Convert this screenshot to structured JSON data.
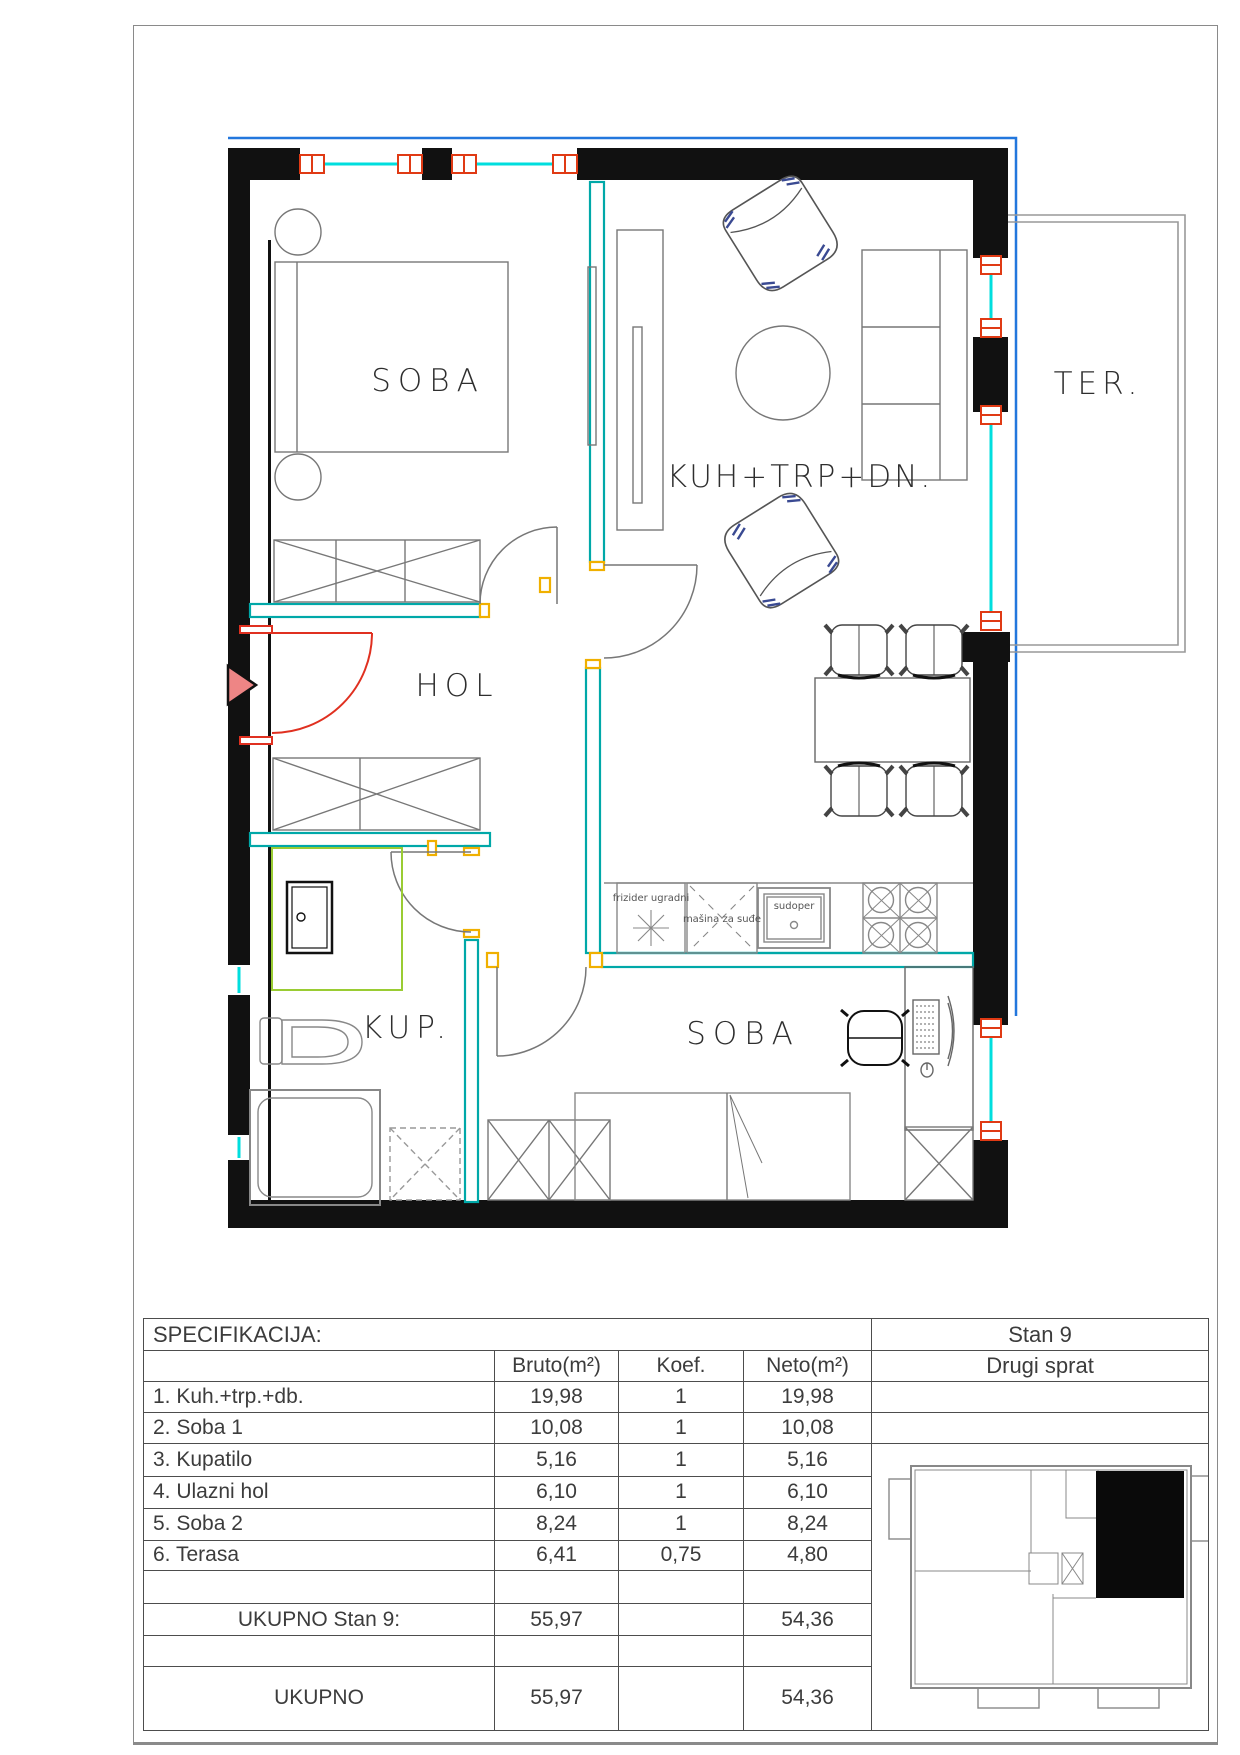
{
  "plan": {
    "rooms": {
      "soba1": "SOBA",
      "living": "KUH+TRP+DN.",
      "hol": "HOL",
      "kup": "KUP.",
      "soba2": "SOBA",
      "terrace": "TER."
    },
    "kitchen_labels": {
      "fridge": "frizider ugradni",
      "dishwasher": "mašina za suđe",
      "sink": "sudoper"
    },
    "colors": {
      "wall": "#111111",
      "glass": "#00dede",
      "window_frame": "#e03a14",
      "partition": "#00a8a8",
      "door_jamb": "#f0b000",
      "entrance_door": "#e03020",
      "entrance_arrow_fill": "#ee8585",
      "facade_line": "#2277dd",
      "shower_glass": "#9acc33",
      "terrace_line": "#999999"
    }
  },
  "table": {
    "title": "SPECIFIKACIJA:",
    "unit": "Stan 9",
    "floor": "Drugi sprat",
    "headers": {
      "bruto": "Bruto(m²)",
      "koef": "Koef.",
      "neto": "Neto(m²)"
    },
    "rows": [
      {
        "name": "1. Kuh.+trp.+db.",
        "bruto": "19,98",
        "koef": "1",
        "neto": "19,98"
      },
      {
        "name": "2. Soba 1",
        "bruto": "10,08",
        "koef": "1",
        "neto": "10,08"
      },
      {
        "name": "3. Kupatilo",
        "bruto": "5,16",
        "koef": "1",
        "neto": "5,16"
      },
      {
        "name": "4. Ulazni hol",
        "bruto": "6,10",
        "koef": "1",
        "neto": "6,10"
      },
      {
        "name": "5. Soba 2",
        "bruto": "8,24",
        "koef": "1",
        "neto": "8,24"
      },
      {
        "name": "6. Terasa",
        "bruto": "6,41",
        "koef": "0,75",
        "neto": "4,80"
      }
    ],
    "totals": [
      {
        "name": "UKUPNO Stan 9:",
        "bruto": "55,97",
        "neto": "54,36"
      },
      {
        "name": "UKUPNO",
        "bruto": "55,97",
        "neto": "54,36"
      }
    ]
  }
}
